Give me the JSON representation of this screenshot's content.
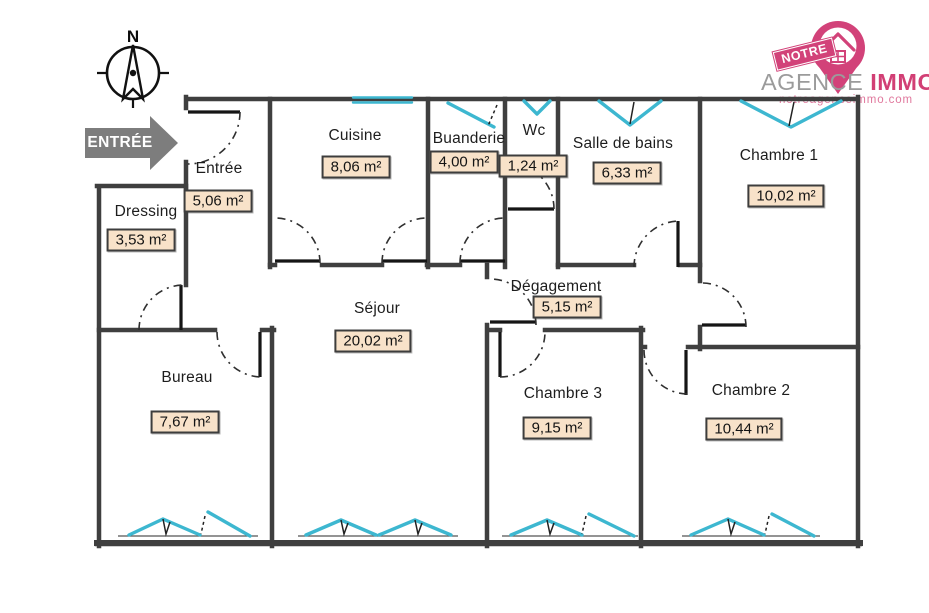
{
  "branding": {
    "ribbon": "NOTRE",
    "agency_gray": "AGENCE",
    "agency_pink": "IMMO",
    "website": "notreagenceimmo.com",
    "pink": "#d24279",
    "gray": "#9b9b9b"
  },
  "compass": {
    "north_label": "N"
  },
  "entrance": {
    "label": "ENTRÉE",
    "arrow_color": "#7d7d7d"
  },
  "colors": {
    "wall": "#3f3f3f",
    "window": "#3db7d0",
    "area_box_bg": "#f8e2c9",
    "area_box_border": "#3d3d3d"
  },
  "rooms": [
    {
      "name": "Entrée",
      "area": "5,06 m²"
    },
    {
      "name": "Cuisine",
      "area": "8,06 m²"
    },
    {
      "name": "Buanderie",
      "area": "4,00 m²"
    },
    {
      "name": "Wc",
      "area": "1,24 m²"
    },
    {
      "name": "Salle de bains",
      "area": "6,33 m²"
    },
    {
      "name": "Chambre 1",
      "area": "10,02 m²"
    },
    {
      "name": "Dressing",
      "area": "3,53 m²"
    },
    {
      "name": "Séjour",
      "area": "20,02 m²"
    },
    {
      "name": "Dégagement",
      "area": "5,15 m²"
    },
    {
      "name": "Bureau",
      "area": "7,67 m²"
    },
    {
      "name": "Chambre 3",
      "area": "9,15 m²"
    },
    {
      "name": "Chambre 2",
      "area": "10,44 m²"
    }
  ]
}
